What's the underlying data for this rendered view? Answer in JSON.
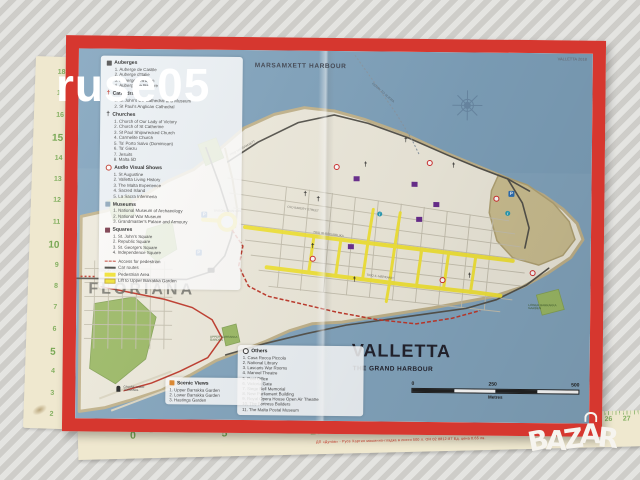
{
  "watermark": {
    "text": "ruse05"
  },
  "logo": {
    "letters": [
      "B",
      "A",
      "Z",
      "A",
      "R"
    ]
  },
  "rulers": {
    "left": {
      "numbers": [
        "18",
        "17",
        "16",
        "15",
        "14",
        "13",
        "12",
        "11",
        "10",
        "9",
        "8",
        "7",
        "6",
        "5",
        "4",
        "3",
        "2"
      ]
    },
    "bottom": {
      "numbers": [
        "0",
        "1",
        "2",
        "3",
        "4",
        "5",
        "6",
        "7",
        "8",
        "9",
        "10",
        "11",
        "12",
        "13",
        "14",
        "15",
        "16",
        "17",
        "18",
        "19",
        "20",
        "21",
        "22",
        "23",
        "24",
        "25",
        "26",
        "27"
      ],
      "red_text": "ДП «Дунав» - Русе   Хартия машинно-гладка   в листи 500 л.   ОН 02 8812-87   Ед. цена 0.65 лв."
    }
  },
  "icons": {
    "cross": "†",
    "parking": "P",
    "info": "i"
  },
  "map": {
    "corner_note": "VALLETTA 2018",
    "labels": {
      "marsamxett": "MARSAMXETT HARBOUR",
      "floriana": "FLORIANA",
      "valletta": "VALLETTA",
      "grand_harbour": "THE GRAND HARBOUR",
      "ferry": "FERRY TO SLIEMA",
      "sunday_market": "SUNDAY MARKET",
      "triton": "TRITON FOUNTAIN",
      "upper_garden": "UPPER BARRAKKA GARDEN",
      "lower_garden": "LOWER BARRAKKA GARDEN",
      "cruise": "CRUISE LINER TERMINAL"
    },
    "streets": [
      "TRIQ IR-REPUBBLIKA",
      "TRIQ IL-MERKANTI",
      "OLD BAKERY STREET",
      "TRIQ MARSAMXETT"
    ],
    "legend": {
      "sections": [
        {
          "title": "Auberges",
          "items": [
            "1. Auberge de Castile",
            "2. Auberge d'Italie",
            "3. Auberge d'Aragon",
            "4. Auberge de Baviere"
          ]
        },
        {
          "title": "Cathedrals",
          "items": [
            "1. St John's Co-Cathedral and Museum",
            "2. St Paul's Anglican Cathedral"
          ]
        },
        {
          "title": "Churches",
          "items": [
            "1. Church of Our Lady of Victory",
            "2. Church of St Catherine",
            "3. St Paul Shipwrecked Church",
            "4. Carmelite Church",
            "5. Ta' Porto Salvo (Dominican)",
            "6. Ta' Giezu",
            "7. Jesuits",
            "8. Malta 5D"
          ]
        },
        {
          "title": "Audio Visual Shows",
          "items": [
            "1. St Augustine",
            "2. Valletta Living History",
            "3. The Malta Experience",
            "4. Sacred Island",
            "5. La Sacra Infermeria"
          ]
        },
        {
          "title": "Museums",
          "items": [
            "1. National Museum of Archaeology",
            "2. National War Museum",
            "3. Grandmaster's Palace and Armoury"
          ]
        },
        {
          "title": "Squares",
          "items": [
            "1. St. John's Square",
            "2. Republic Square",
            "3. St. George's Square",
            "4. Independence Square"
          ]
        }
      ],
      "lines": [
        {
          "label": "Access for pedestrian",
          "swatch": "red-dashed"
        },
        {
          "label": "Car routes",
          "swatch": "dark-line"
        },
        {
          "label": "Pedestrian Area",
          "swatch": "yellow-block"
        },
        {
          "label": "Lift to Upper Barrakka Garden",
          "swatch": "lift-block"
        }
      ]
    },
    "others": {
      "title": "Others",
      "items": [
        "1. Casa Rocca Piccola",
        "2. National Library",
        "3. Lascaris War Rooms",
        "4. Manoel Theatre",
        "5. Post Office",
        "6. Victoria Gate",
        "7. Siege Bell Memorial",
        "8. New Parliament Building",
        "9. Royal Opera House Open Air Theatre",
        "10. The Fortress Builders",
        "11. The Malta Postal Museum"
      ]
    },
    "scenic": {
      "title": "Scenic Views",
      "items": [
        "1. Upper Barrakka Garden",
        "2. Lower Barrakka Garden",
        "3. Hastings Garden"
      ]
    },
    "scale": {
      "zero": "0",
      "mid": "250",
      "max": "500",
      "unit": "Metres"
    },
    "colors": {
      "sea": "#84a6bf",
      "land": "#efebdd",
      "park": "#9dbb66",
      "pedestrian": "#f4e535",
      "route_red": "#c0392b",
      "cover_red": "#d6372f"
    }
  }
}
